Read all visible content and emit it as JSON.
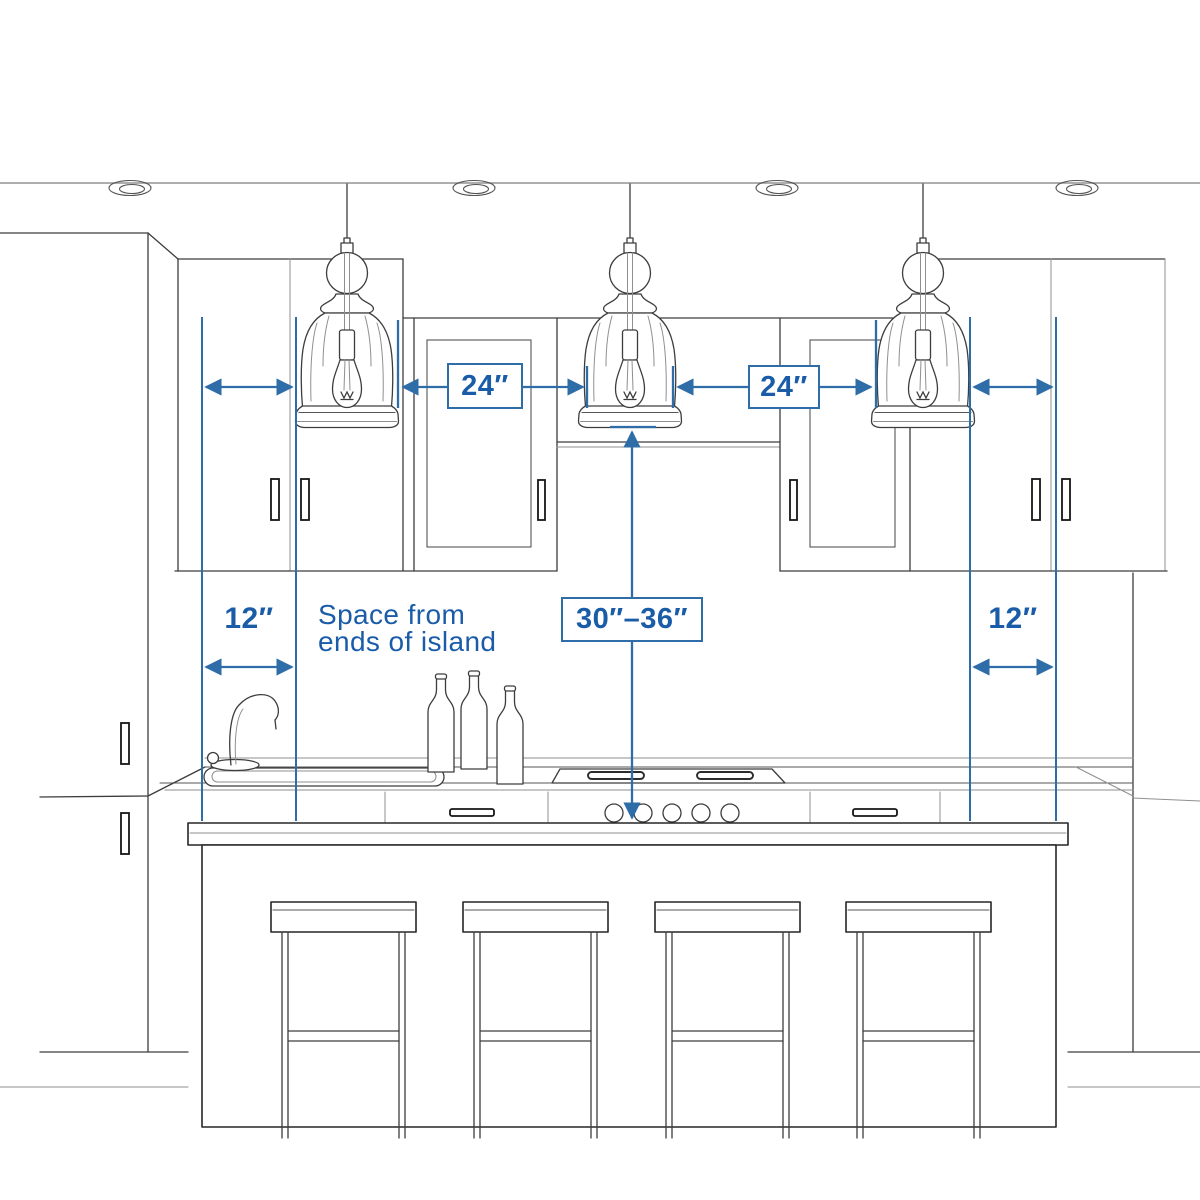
{
  "diagram": {
    "type": "kitchen-island-pendant-spacing-guide",
    "labels": {
      "pendant_gap_left": "24″",
      "pendant_gap_right": "24″",
      "island_end_left": "12″",
      "island_end_right": "12″",
      "pendant_height": "30″–36″"
    },
    "caption": {
      "line1": "Space from",
      "line2": "ends of island"
    },
    "colors": {
      "dimension_line": "#2e6da8",
      "dimension_text": "#1a5ca8",
      "sketch": "#3d3d3d"
    }
  }
}
